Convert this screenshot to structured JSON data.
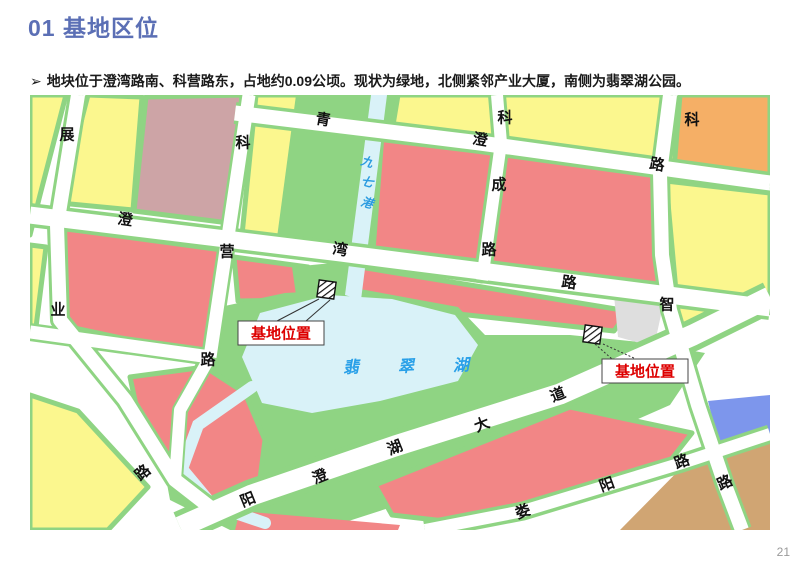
{
  "slide": {
    "title": "01 基地区位",
    "title_color": "#5b6fb5",
    "bullet_marker": "➢",
    "bullet_text": "地块位于澄湾路南、科营路东，占地约0.09公顷。现状为绿地，北侧紧邻产业大厦，南侧为翡翠湖公园。",
    "page_number": "21"
  },
  "map": {
    "palette": {
      "yellow": "#FBF78E",
      "green": "#8FD483",
      "red": "#F28686",
      "mauve": "#CDA4A6",
      "orange": "#F5AF66",
      "tan": "#D0A573",
      "blue": "#7D96EC",
      "water": "#D9F2F8",
      "gray": "#DEDEDE",
      "road_white": "#FFFFFF",
      "river_label": "#2A9BE0",
      "lake_label": "#29A0E8",
      "callout_red": "#DD0000"
    },
    "blocks": [
      {
        "name": "block-yellow-topleft-sliver",
        "fill": "yellow",
        "edge": true,
        "pts": [
          [
            0,
            0
          ],
          [
            36,
            0
          ],
          [
            10,
            100
          ],
          [
            0,
            140
          ]
        ]
      },
      {
        "name": "block-yellow-a",
        "fill": "yellow",
        "edge": true,
        "pts": [
          [
            58,
            0
          ],
          [
            112,
            2
          ],
          [
            103,
            115
          ],
          [
            30,
            108
          ]
        ]
      },
      {
        "name": "block-mauve",
        "fill": "mauve",
        "edge": true,
        "pts": [
          [
            116,
            2
          ],
          [
            212,
            0
          ],
          [
            199,
            128
          ],
          [
            104,
            116
          ]
        ]
      },
      {
        "name": "block-yellow-b",
        "fill": "yellow",
        "edge": true,
        "pts": [
          [
            226,
            0
          ],
          [
            298,
            0
          ],
          [
            288,
            150
          ],
          [
            212,
            140
          ]
        ]
      },
      {
        "name": "block-green-river-corridor",
        "fill": "green",
        "edge": false,
        "pts": [
          [
            266,
            0
          ],
          [
            374,
            0
          ],
          [
            350,
            165
          ],
          [
            246,
            150
          ]
        ]
      },
      {
        "name": "block-yellow-river-east",
        "fill": "yellow",
        "edge": true,
        "pts": [
          [
            368,
            0
          ],
          [
            470,
            0
          ],
          [
            472,
            46
          ],
          [
            362,
            36
          ]
        ]
      },
      {
        "name": "block-red-topmid",
        "fill": "red",
        "edge": true,
        "pts": [
          [
            352,
            40
          ],
          [
            468,
            50
          ],
          [
            452,
            186
          ],
          [
            342,
            168
          ]
        ]
      },
      {
        "name": "block-yellow-c",
        "fill": "yellow",
        "edge": true,
        "pts": [
          [
            472,
            0
          ],
          [
            640,
            0
          ],
          [
            646,
            78
          ],
          [
            476,
            50
          ]
        ]
      },
      {
        "name": "block-red-big-top",
        "fill": "red",
        "edge": true,
        "pts": [
          [
            470,
            50
          ],
          [
            645,
            80
          ],
          [
            634,
            200
          ],
          [
            455,
            180
          ]
        ]
      },
      {
        "name": "block-orange",
        "fill": "orange",
        "edge": true,
        "pts": [
          [
            650,
            0
          ],
          [
            740,
            0
          ],
          [
            740,
            86
          ],
          [
            644,
            74
          ]
        ]
      },
      {
        "name": "block-yellow-d",
        "fill": "yellow",
        "edge": true,
        "pts": [
          [
            636,
            86
          ],
          [
            740,
            98
          ],
          [
            740,
            198
          ],
          [
            650,
            240
          ]
        ]
      },
      {
        "name": "block-yellow-left-sliver2",
        "fill": "yellow",
        "edge": true,
        "pts": [
          [
            0,
            150
          ],
          [
            16,
            152
          ],
          [
            6,
            232
          ],
          [
            0,
            232
          ]
        ]
      },
      {
        "name": "block-red-midleft",
        "fill": "red",
        "edge": true,
        "pts": [
          [
            30,
            133
          ],
          [
            200,
            156
          ],
          [
            181,
            262
          ],
          [
            30,
            230
          ]
        ]
      },
      {
        "name": "block-red-midright-west",
        "fill": "red",
        "edge": true,
        "pts": [
          [
            204,
            162
          ],
          [
            278,
            172
          ],
          [
            272,
            205
          ],
          [
            208,
            206
          ]
        ]
      },
      {
        "name": "block-red-midright-east",
        "fill": "red",
        "edge": true,
        "pts": [
          [
            318,
            170
          ],
          [
            598,
            216
          ],
          [
            584,
            236
          ],
          [
            310,
            206
          ]
        ]
      },
      {
        "name": "block-park",
        "fill": "green",
        "edge": false,
        "pts": [
          [
            190,
            212
          ],
          [
            255,
            198
          ],
          [
            330,
            194
          ],
          [
            428,
            212
          ],
          [
            455,
            240
          ],
          [
            540,
            240
          ],
          [
            620,
            248
          ],
          [
            675,
            258
          ],
          [
            640,
            310
          ],
          [
            560,
            345
          ],
          [
            430,
            390
          ],
          [
            300,
            432
          ],
          [
            210,
            440
          ],
          [
            140,
            405
          ],
          [
            128,
            340
          ],
          [
            165,
            270
          ]
        ]
      },
      {
        "name": "block-green-site1-wedge",
        "fill": "green",
        "edge": false,
        "pts": [
          [
            262,
            172
          ],
          [
            322,
            166
          ],
          [
            330,
            212
          ],
          [
            268,
            214
          ]
        ]
      },
      {
        "name": "block-red-pentagon",
        "fill": "red",
        "edge": true,
        "pts": [
          [
            100,
            282
          ],
          [
            175,
            272
          ],
          [
            215,
            298
          ],
          [
            235,
            345
          ],
          [
            228,
            400
          ],
          [
            168,
            416
          ],
          [
            112,
            338
          ]
        ]
      },
      {
        "name": "block-yellow-e",
        "fill": "yellow",
        "edge": true,
        "pts": [
          [
            0,
            300
          ],
          [
            48,
            316
          ],
          [
            118,
            392
          ],
          [
            78,
            435
          ],
          [
            0,
            435
          ]
        ]
      },
      {
        "name": "block-red-bottomstrip",
        "fill": "red",
        "edge": false,
        "pts": [
          [
            210,
            416
          ],
          [
            370,
            430
          ],
          [
            368,
            435
          ],
          [
            205,
            435
          ]
        ]
      },
      {
        "name": "block-red-avenue-louyang",
        "fill": "red",
        "edge": true,
        "pts": [
          [
            345,
            390
          ],
          [
            540,
            312
          ],
          [
            662,
            338
          ],
          [
            640,
            366
          ],
          [
            432,
            428
          ],
          [
            362,
            420
          ]
        ]
      },
      {
        "name": "block-gray",
        "fill": "gray",
        "edge": false,
        "pts": [
          [
            584,
            200
          ],
          [
            634,
            206
          ],
          [
            624,
            252
          ],
          [
            588,
            242
          ]
        ]
      },
      {
        "name": "block-blue",
        "fill": "blue",
        "edge": false,
        "pts": [
          [
            678,
            306
          ],
          [
            740,
            300
          ],
          [
            740,
            348
          ],
          [
            688,
            346
          ]
        ]
      },
      {
        "name": "block-tan",
        "fill": "tan",
        "edge": false,
        "pts": [
          [
            662,
            362
          ],
          [
            740,
            347
          ],
          [
            740,
            435
          ],
          [
            590,
            435
          ]
        ]
      }
    ],
    "waters": {
      "lake_pts": [
        [
          230,
          218
        ],
        [
          298,
          200
        ],
        [
          362,
          204
        ],
        [
          425,
          220
        ],
        [
          448,
          250
        ],
        [
          428,
          286
        ],
        [
          350,
          306
        ],
        [
          282,
          318
        ],
        [
          232,
          308
        ],
        [
          212,
          262
        ]
      ],
      "river_pts": [
        [
          341,
          0
        ],
        [
          357,
          0
        ],
        [
          331,
          205
        ],
        [
          315,
          200
        ]
      ],
      "channel_pts": [
        [
          222,
          292
        ],
        [
          168,
          330
        ],
        [
          152,
          374
        ],
        [
          182,
          410
        ],
        [
          235,
          428
        ]
      ],
      "channel_width": 12
    },
    "roads": [
      {
        "name": "road-qingcheng",
        "green": 22,
        "white": 15,
        "pts": [
          [
            205,
            18
          ],
          [
            450,
            48
          ],
          [
            740,
            88
          ]
        ]
      },
      {
        "name": "road-chengwan",
        "green": 24,
        "white": 17,
        "pts": [
          [
            0,
            120
          ],
          [
            310,
            158
          ],
          [
            740,
            213
          ]
        ]
      },
      {
        "name": "road-zhanye",
        "green": 20,
        "white": 14,
        "pts": [
          [
            48,
            0
          ],
          [
            27,
            130
          ],
          [
            30,
            225
          ],
          [
            95,
            305
          ],
          [
            145,
            385
          ],
          [
            190,
            420
          ]
        ]
      },
      {
        "name": "road-keying",
        "green": 18,
        "white": 13,
        "pts": [
          [
            219,
            0
          ],
          [
            196,
            155
          ],
          [
            180,
            262
          ]
        ]
      },
      {
        "name": "road-connector-a1",
        "green": 18,
        "white": 13,
        "pts": [
          [
            0,
            237
          ],
          [
            180,
            262
          ]
        ]
      },
      {
        "name": "road-connector-a3",
        "green": 16,
        "white": 12,
        "pts": [
          [
            180,
            262
          ],
          [
            150,
            315
          ],
          [
            145,
            385
          ]
        ]
      },
      {
        "name": "road-kecheng",
        "green": 18,
        "white": 12,
        "pts": [
          [
            467,
            0
          ],
          [
            471,
            48
          ],
          [
            452,
            185
          ]
        ]
      },
      {
        "name": "road-zhi",
        "green": 20,
        "white": 14,
        "pts": [
          [
            640,
            0
          ],
          [
            630,
            78
          ],
          [
            632,
            160
          ],
          [
            640,
            215
          ],
          [
            668,
            310
          ],
          [
            695,
            390
          ],
          [
            712,
            435
          ]
        ]
      },
      {
        "name": "road-yangchenghu-avenue",
        "green": 32,
        "white": 21,
        "pts": [
          [
            150,
            432
          ],
          [
            222,
            400
          ],
          [
            365,
            351
          ],
          [
            530,
            299
          ],
          [
            663,
            240
          ],
          [
            740,
            202
          ]
        ]
      },
      {
        "name": "road-louyang",
        "green": 19,
        "white": 12,
        "pts": [
          [
            395,
            435
          ],
          [
            493,
            416
          ],
          [
            652,
            368
          ],
          [
            740,
            339
          ]
        ]
      }
    ],
    "labels": [
      {
        "t": "展",
        "x": 37,
        "y": 40,
        "r": 0,
        "k": "road"
      },
      {
        "t": "业",
        "x": 28,
        "y": 215,
        "r": 0,
        "k": "road"
      },
      {
        "t": "科",
        "x": 213,
        "y": 48,
        "r": 0,
        "k": "road"
      },
      {
        "t": "营",
        "x": 197,
        "y": 157,
        "r": 0,
        "k": "road"
      },
      {
        "t": "路",
        "x": 178,
        "y": 265,
        "r": 0,
        "k": "road"
      },
      {
        "t": "青",
        "x": 293,
        "y": 25,
        "r": 10,
        "k": "road"
      },
      {
        "t": "澄",
        "x": 450,
        "y": 45,
        "r": 10,
        "k": "road"
      },
      {
        "t": "路",
        "x": 627,
        "y": 70,
        "r": 10,
        "k": "road"
      },
      {
        "t": "澄",
        "x": 95,
        "y": 125,
        "r": 8,
        "k": "road"
      },
      {
        "t": "湾",
        "x": 310,
        "y": 155,
        "r": 8,
        "k": "road"
      },
      {
        "t": "路",
        "x": 539,
        "y": 188,
        "r": 8,
        "k": "road"
      },
      {
        "t": "科",
        "x": 475,
        "y": 23,
        "r": 0,
        "k": "road"
      },
      {
        "t": "成",
        "x": 469,
        "y": 90,
        "r": 0,
        "k": "road"
      },
      {
        "t": "路",
        "x": 459,
        "y": 155,
        "r": 0,
        "k": "road"
      },
      {
        "t": "科",
        "x": 662,
        "y": 25,
        "r": 0,
        "k": "road"
      },
      {
        "t": "智",
        "x": 637,
        "y": 210,
        "r": 0,
        "k": "road"
      },
      {
        "t": "路",
        "x": 695,
        "y": 388,
        "r": -25,
        "k": "road"
      },
      {
        "t": "阳",
        "x": 218,
        "y": 405,
        "r": -22,
        "k": "road"
      },
      {
        "t": "澄",
        "x": 290,
        "y": 382,
        "r": -22,
        "k": "road"
      },
      {
        "t": "湖",
        "x": 365,
        "y": 353,
        "r": -22,
        "k": "road"
      },
      {
        "t": "大",
        "x": 452,
        "y": 330,
        "r": -22,
        "k": "road"
      },
      {
        "t": "道",
        "x": 528,
        "y": 300,
        "r": -22,
        "k": "road"
      },
      {
        "t": "娄",
        "x": 493,
        "y": 417,
        "r": -20,
        "k": "road"
      },
      {
        "t": "阳",
        "x": 577,
        "y": 390,
        "r": -20,
        "k": "road"
      },
      {
        "t": "路",
        "x": 652,
        "y": 367,
        "r": -20,
        "k": "road"
      },
      {
        "t": "路",
        "x": 113,
        "y": 378,
        "r": -40,
        "k": "road"
      },
      {
        "t": "九",
        "x": 337,
        "y": 67,
        "r": 15,
        "k": "river"
      },
      {
        "t": "七",
        "x": 337,
        "y": 87,
        "r": 15,
        "k": "river"
      },
      {
        "t": "港",
        "x": 337,
        "y": 108,
        "r": 15,
        "k": "river"
      },
      {
        "t": "翡",
        "x": 322,
        "y": 273,
        "r": -3,
        "k": "lake"
      },
      {
        "t": "翠",
        "x": 377,
        "y": 272,
        "r": -3,
        "k": "lake"
      },
      {
        "t": "湖",
        "x": 432,
        "y": 271,
        "r": -3,
        "k": "lake"
      }
    ],
    "site_markers": [
      {
        "name": "site-marker-1",
        "x": 288,
        "y": 186,
        "size": 17,
        "rot": 8
      },
      {
        "name": "site-marker-2",
        "x": 554,
        "y": 231,
        "size": 17,
        "rot": 8
      }
    ],
    "callouts": [
      {
        "name": "site-callout-1",
        "label": "基地位置",
        "box": [
          208,
          226,
          86,
          24
        ],
        "dashed": false,
        "leaders": [
          [
            247,
            226,
            289,
            204
          ],
          [
            276,
            226,
            300,
            205
          ]
        ]
      },
      {
        "name": "site-callout-2",
        "label": "基地位置",
        "box": [
          572,
          264,
          86,
          24
        ],
        "dashed": true,
        "leaders": [
          [
            565,
            249,
            582,
            264
          ],
          [
            573,
            249,
            606,
            264
          ]
        ]
      }
    ]
  }
}
